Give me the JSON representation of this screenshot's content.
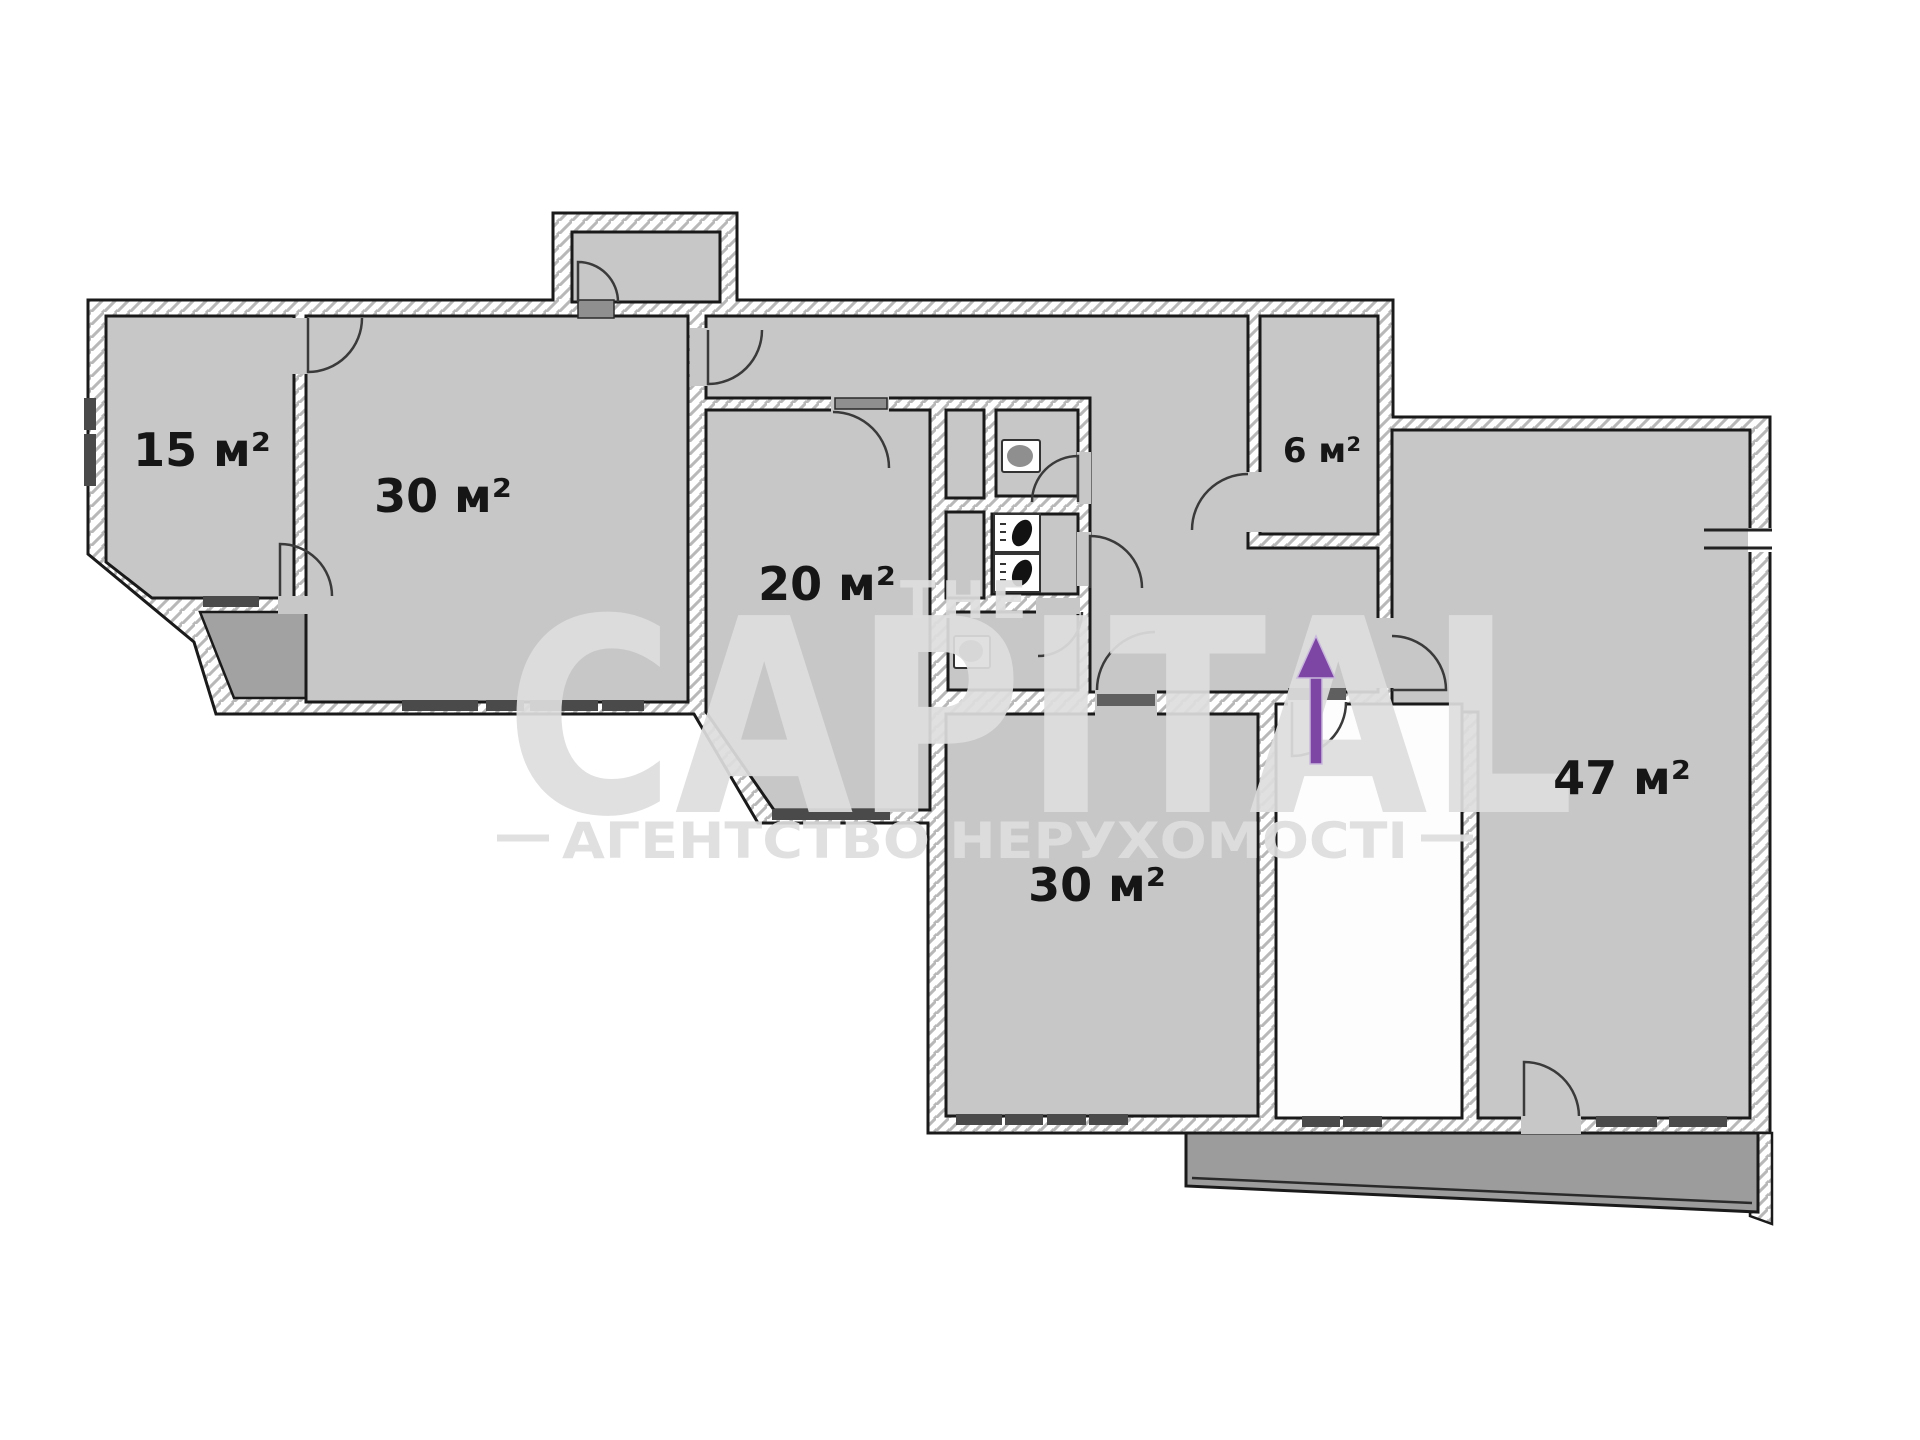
{
  "title": "Apartment floor plan",
  "rooms": [
    {
      "id": "room-15",
      "label": "15 м²"
    },
    {
      "id": "room-30-top",
      "label": "30 м²"
    },
    {
      "id": "room-20",
      "label": "20 м²"
    },
    {
      "id": "room-6",
      "label": "6 м²"
    },
    {
      "id": "room-47",
      "label": "47 м²"
    },
    {
      "id": "room-30-bottom",
      "label": "30 м²"
    }
  ],
  "watermark": {
    "brand_top": "THE",
    "brand": "CAPITAL",
    "tagline": "АГЕНТСТВО НЕРУХОМОСТІ"
  },
  "icons": [
    "entrance-arrow-icon",
    "toilet-icon",
    "toilet-icon",
    "washbasin-icon",
    "washbasin-icon",
    "door-swing-icon"
  ],
  "colors": {
    "room_fill": "#c7c7c7",
    "balcony_fill": "#9c9c9c",
    "wall_line": "#1a1a1a",
    "window_bar": "#4a4a4a",
    "entrance_arrow": "#7d45a4",
    "watermark": "#dedede"
  }
}
